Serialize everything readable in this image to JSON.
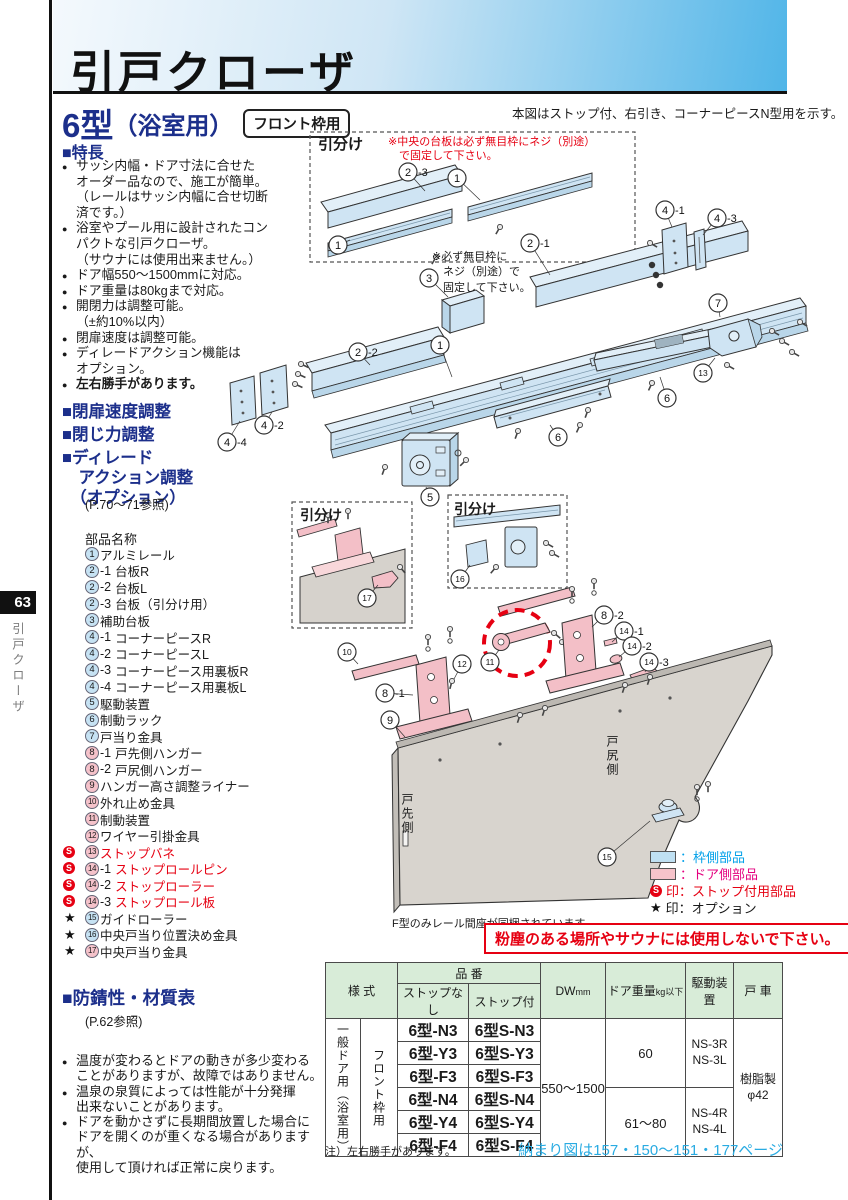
{
  "page": {
    "tab": "63",
    "side_label": "引戸クローザ",
    "title": "引戸クローザ"
  },
  "intro": {
    "model": "6型",
    "model_sub": "（浴室用）",
    "badge": "フロント枠用",
    "diagram_note": "本図はストップ付、右引き、コーナーピースN型用を示す。"
  },
  "features": {
    "heading": "■特長",
    "items": [
      {
        "text": "サッシ内幅・ドア寸法に合せた\nオーダー品なので、施工が簡単。\n（レールはサッシ内幅に合せ切断\n済です。）",
        "bold": false
      },
      {
        "text": "浴室やプール用に設計されたコン\nパクトな引戸クローザ。\n（サウナには使用出来ません。）",
        "bold": false
      },
      {
        "text": "ドア幅550～1500mmに対応。",
        "bold": false
      },
      {
        "text": "ドア重量は80kgまで対応。",
        "bold": false
      },
      {
        "text": "開閉力は調整可能。\n（±約10%以内）",
        "bold": false
      },
      {
        "text": "閉扉速度は調整可能。",
        "bold": false
      },
      {
        "text": "ディレードアクション機能は\nオプション。",
        "bold": false
      },
      {
        "text": "左右勝手があります。",
        "bold": true
      }
    ]
  },
  "adjust": {
    "headings": [
      "■閉扉速度調整",
      "■閉じ力調整",
      "■ディレード\n　アクション調整\n　（オプション）"
    ],
    "ref": "(P.70～71参照)"
  },
  "parts": {
    "heading": "部品名称",
    "items": [
      {
        "num": "1",
        "suffix": "",
        "label": "アルミレール",
        "side": "frame",
        "stop": false,
        "option": false
      },
      {
        "num": "2",
        "suffix": "-1",
        "label": "台板R",
        "side": "frame",
        "stop": false,
        "option": false
      },
      {
        "num": "2",
        "suffix": "-2",
        "label": "台板L",
        "side": "frame",
        "stop": false,
        "option": false
      },
      {
        "num": "2",
        "suffix": "-3",
        "label": "台板（引分け用）",
        "side": "frame",
        "stop": false,
        "option": false
      },
      {
        "num": "3",
        "suffix": "",
        "label": "補助台板",
        "side": "frame",
        "stop": false,
        "option": false
      },
      {
        "num": "4",
        "suffix": "-1",
        "label": "コーナーピースR",
        "side": "frame",
        "stop": false,
        "option": false
      },
      {
        "num": "4",
        "suffix": "-2",
        "label": "コーナーピースL",
        "side": "frame",
        "stop": false,
        "option": false
      },
      {
        "num": "4",
        "suffix": "-3",
        "label": "コーナーピース用裏板R",
        "side": "frame",
        "stop": false,
        "option": false
      },
      {
        "num": "4",
        "suffix": "-4",
        "label": "コーナーピース用裏板L",
        "side": "frame",
        "stop": false,
        "option": false
      },
      {
        "num": "5",
        "suffix": "",
        "label": "駆動装置",
        "side": "frame",
        "stop": false,
        "option": false
      },
      {
        "num": "6",
        "suffix": "",
        "label": "制動ラック",
        "side": "frame",
        "stop": false,
        "option": false
      },
      {
        "num": "7",
        "suffix": "",
        "label": "戸当り金具",
        "side": "frame",
        "stop": false,
        "option": false
      },
      {
        "num": "8",
        "suffix": "-1",
        "label": "戸先側ハンガー",
        "side": "door",
        "stop": false,
        "option": false
      },
      {
        "num": "8",
        "suffix": "-2",
        "label": "戸尻側ハンガー",
        "side": "door",
        "stop": false,
        "option": false
      },
      {
        "num": "9",
        "suffix": "",
        "label": "ハンガー高さ調整ライナー",
        "side": "door",
        "stop": false,
        "option": false
      },
      {
        "num": "10",
        "suffix": "",
        "label": "外れ止め金具",
        "side": "door",
        "stop": false,
        "option": false
      },
      {
        "num": "11",
        "suffix": "",
        "label": "制動装置",
        "side": "door",
        "stop": false,
        "option": false
      },
      {
        "num": "12",
        "suffix": "",
        "label": "ワイヤー引掛金具",
        "side": "door",
        "stop": false,
        "option": false
      },
      {
        "num": "13",
        "suffix": "",
        "label": "ストップバネ",
        "side": "door",
        "stop": true,
        "option": false
      },
      {
        "num": "14",
        "suffix": "-1",
        "label": "ストップロールピン",
        "side": "door",
        "stop": true,
        "option": false
      },
      {
        "num": "14",
        "suffix": "-2",
        "label": "ストップローラー",
        "side": "door",
        "stop": true,
        "option": false
      },
      {
        "num": "14",
        "suffix": "-3",
        "label": "ストップロール板",
        "side": "door",
        "stop": true,
        "option": false
      },
      {
        "num": "15",
        "suffix": "",
        "label": "ガイドローラー",
        "side": "frame",
        "stop": false,
        "option": true
      },
      {
        "num": "16",
        "suffix": "",
        "label": "中央戸当り位置決め金具",
        "side": "frame",
        "stop": false,
        "option": true
      },
      {
        "num": "17",
        "suffix": "",
        "label": "中央戸当り金具",
        "side": "door",
        "stop": false,
        "option": true
      }
    ]
  },
  "rust": {
    "heading": "■防錆性・材質表",
    "ref": "(P.62参照)"
  },
  "notes": [
    "温度が変わるとドアの動きが多少変わる\nことがありますが、故障ではありません。",
    "温泉の泉質によっては性能が十分発揮\n出来ないことがあります。",
    "ドアを動かさずに長期間放置した場合に\nドアを開くのが重くなる場合がありますが、\n使用して頂ければ正常に戻ります。"
  ],
  "diagram": {
    "hikiwake": "引分け",
    "red_note": "※中央の台板は必ず無目枠にネジ（別途）\n　で固定して下さい。",
    "screw_note": "※必ず無目枠に\n　ネジ（別途）で\n　固定して下さい。",
    "door_front": "戸先側",
    "door_rear": "戸尻側",
    "f_note": "F型のみレール間座が同梱されています。",
    "warning": "粉塵のある場所やサウナには使用しないで下さい。",
    "legend": [
      {
        "swatch": "blue",
        "text": "：枠側部品",
        "color": "#00a0e9"
      },
      {
        "swatch": "pink",
        "text": "：ドア側部品",
        "color": "#e4007f"
      },
      {
        "swatch": "s",
        "text": "印：ストップ付用部品",
        "color": "#e60012"
      },
      {
        "swatch": "star",
        "text": "印：オプション",
        "color": "#1a1a1a"
      }
    ],
    "callouts": [
      {
        "n": "2",
        "sub": "-3",
        "x": 208,
        "y": 57,
        "lx": 225,
        "ly": 76
      },
      {
        "n": "1",
        "sub": "",
        "x": 257,
        "y": 63,
        "lx": 280,
        "ly": 85
      },
      {
        "n": "1",
        "sub": "",
        "x": 138,
        "y": 130,
        "lx": 150,
        "ly": 125
      },
      {
        "n": "3",
        "sub": "",
        "x": 229,
        "y": 163,
        "lx": 248,
        "ly": 182
      },
      {
        "n": "2",
        "sub": "-1",
        "x": 330,
        "y": 128,
        "lx": 350,
        "ly": 160
      },
      {
        "n": "4",
        "sub": "-1",
        "x": 465,
        "y": 95,
        "lx": 472,
        "ly": 112
      },
      {
        "n": "4",
        "sub": "-3",
        "x": 517,
        "y": 103,
        "lx": 503,
        "ly": 120
      },
      {
        "n": "2",
        "sub": "-2",
        "x": 158,
        "y": 237,
        "lx": 170,
        "ly": 250
      },
      {
        "n": "4",
        "sub": "-2",
        "x": 64,
        "y": 310,
        "lx": 72,
        "ly": 297
      },
      {
        "n": "4",
        "sub": "-4",
        "x": 27,
        "y": 327,
        "lx": 40,
        "ly": 306
      },
      {
        "n": "1",
        "sub": "",
        "x": 240,
        "y": 230,
        "lx": 252,
        "ly": 262
      },
      {
        "n": "5",
        "sub": "",
        "x": 230,
        "y": 382,
        "lx": 226,
        "ly": 372
      },
      {
        "n": "6",
        "sub": "",
        "x": 358,
        "y": 322,
        "lx": 350,
        "ly": 310
      },
      {
        "n": "6",
        "sub": "",
        "x": 467,
        "y": 283,
        "lx": 460,
        "ly": 262
      },
      {
        "n": "7",
        "sub": "",
        "x": 518,
        "y": 188,
        "lx": 520,
        "ly": 202
      },
      {
        "n": "13",
        "sub": "",
        "x": 503,
        "y": 258,
        "lx": 515,
        "ly": 243
      },
      {
        "n": "17",
        "sub": "",
        "x": 167,
        "y": 483,
        "lx": 178,
        "ly": 470
      },
      {
        "n": "16",
        "sub": "",
        "x": 260,
        "y": 464,
        "lx": 270,
        "ly": 450
      },
      {
        "n": "11",
        "sub": "",
        "x": 290,
        "y": 547,
        "lx": 299,
        "ly": 535
      },
      {
        "n": "8",
        "sub": "-2",
        "x": 404,
        "y": 500,
        "lx": 392,
        "ly": 512
      },
      {
        "n": "14",
        "sub": "-1",
        "x": 424,
        "y": 516,
        "lx": 412,
        "ly": 527
      },
      {
        "n": "14",
        "sub": "-2",
        "x": 432,
        "y": 531,
        "lx": 419,
        "ly": 542
      },
      {
        "n": "14",
        "sub": "-3",
        "x": 449,
        "y": 547,
        "lx": 445,
        "ly": 557
      },
      {
        "n": "10",
        "sub": "",
        "x": 147,
        "y": 537,
        "lx": 158,
        "ly": 549
      },
      {
        "n": "8",
        "sub": "-1",
        "x": 185,
        "y": 578,
        "lx": 213,
        "ly": 580
      },
      {
        "n": "12",
        "sub": "",
        "x": 262,
        "y": 549,
        "lx": 254,
        "ly": 564
      },
      {
        "n": "9",
        "sub": "",
        "x": 190,
        "y": 605,
        "lx": 205,
        "ly": 622
      },
      {
        "n": "15",
        "sub": "",
        "x": 407,
        "y": 742,
        "lx": 450,
        "ly": 706
      }
    ]
  },
  "table": {
    "headers": {
      "yoshiki": "様 式",
      "hinban": "品 番",
      "stop_none": "ストップなし",
      "stop_with": "ストップ付",
      "dw": "DW",
      "dw_unit": "mm",
      "weight": "ドア重量",
      "weight_unit": "kg以下",
      "drive": "駆動装置",
      "wheel": "戸 車"
    },
    "type_label": "一般ドア用（浴室用）",
    "frame_label": "フロント枠用",
    "models": [
      [
        "6型-N3",
        "6型S-N3"
      ],
      [
        "6型-Y3",
        "6型S-Y3"
      ],
      [
        "6型-F3",
        "6型S-F3"
      ],
      [
        "6型-N4",
        "6型S-N4"
      ],
      [
        "6型-Y4",
        "6型S-Y4"
      ],
      [
        "6型-F4",
        "6型S-F4"
      ]
    ],
    "dw": "550～1500",
    "groups": [
      {
        "weight": "60",
        "drive": "NS-3R\nNS-3L"
      },
      {
        "weight": "61～80",
        "drive": "NS-4R\nNS-4L"
      }
    ],
    "wheel": "樹脂製\nφ42",
    "note": "注）左右勝手があります。",
    "page_ref": "納まり図は157・150～151・177ページ"
  }
}
